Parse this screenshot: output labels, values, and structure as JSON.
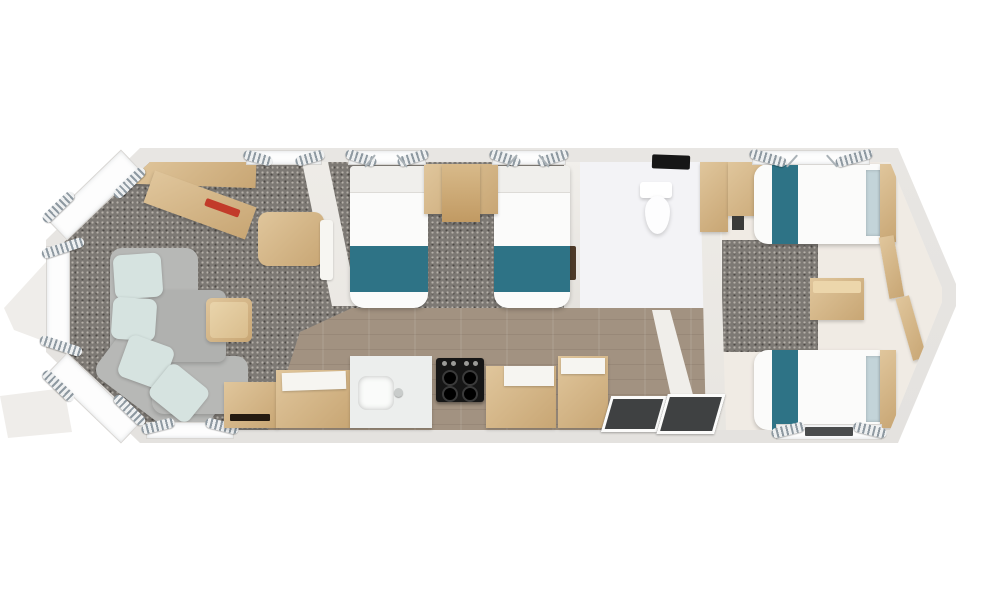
{
  "scene": {
    "label": "Top-down 3D floor plan render of a static caravan holiday home",
    "background": "#ffffff"
  },
  "colors": {
    "background": "#ffffff",
    "shell": "#eae8e5",
    "interior": "#f2f0ec",
    "wall": "#e5e2dd",
    "carpet": "#7d7974",
    "carpet_speck_light": "#b5b0a9",
    "carpet_speck_dark": "#4f4b47",
    "wood_floor": "#a29281",
    "wood": "#e0c69c",
    "wood_dark": "#c8a674",
    "worktop": "#f6f5f1",
    "window": "#fdfdfd",
    "curtain": "#8e99a1",
    "rail": "#aab2b7",
    "teal": "#2e7386",
    "mint": "#d6e3e0",
    "sofa_gray": "#b7b8b6",
    "headboard": "#c3d4d9",
    "cream_floor": "#f0ebe4",
    "bathroom_floor": "#f3f3f6",
    "hob": "#161616",
    "mat": "#3f4142",
    "red": "#c23b2a",
    "mirror": "#4e3b28"
  },
  "rooms": {
    "lounge": {
      "label": "Front lounge with bay windows, L-shaped sofa and coffee table"
    },
    "dining": {
      "label": "Dining area with table and bench seat"
    },
    "kitchen": {
      "label": "Kitchen with sink, cooker, worktops and units"
    },
    "twin_bedroom": {
      "label": "Twin bedroom with two single beds"
    },
    "bathroom": {
      "label": "Shower room with toilet"
    },
    "entrance": {
      "label": "Entrance hall with door mats"
    },
    "rear_bedroom": {
      "label": "Rear twin bedroom with two single beds"
    }
  },
  "furniture": {
    "sofa": {
      "label": "L-shaped sofa with mint cushions"
    },
    "coffee_table": {
      "label": "Wooden coffee table"
    },
    "dining_table": {
      "label": "Wooden dining table"
    },
    "bench": {
      "label": "Dining bench seat"
    },
    "media_unit": {
      "label": "Media unit with electric fire"
    },
    "sink": {
      "label": "Kitchen sink"
    },
    "cooker": {
      "label": "Cooker hob"
    },
    "fridge": {
      "label": "Tall kitchen unit"
    },
    "heater": {
      "label": "Heater cabinet"
    },
    "toilet": {
      "label": "Toilet"
    },
    "twin_beds": {
      "label": "Two single beds with teal runners"
    },
    "rear_beds": {
      "label": "Two single beds with teal runners and headboards"
    },
    "chest": {
      "label": "Bedside chest of drawers"
    },
    "shelves": {
      "label": "Wall shelves"
    },
    "mats": {
      "label": "Entrance door mats"
    }
  }
}
